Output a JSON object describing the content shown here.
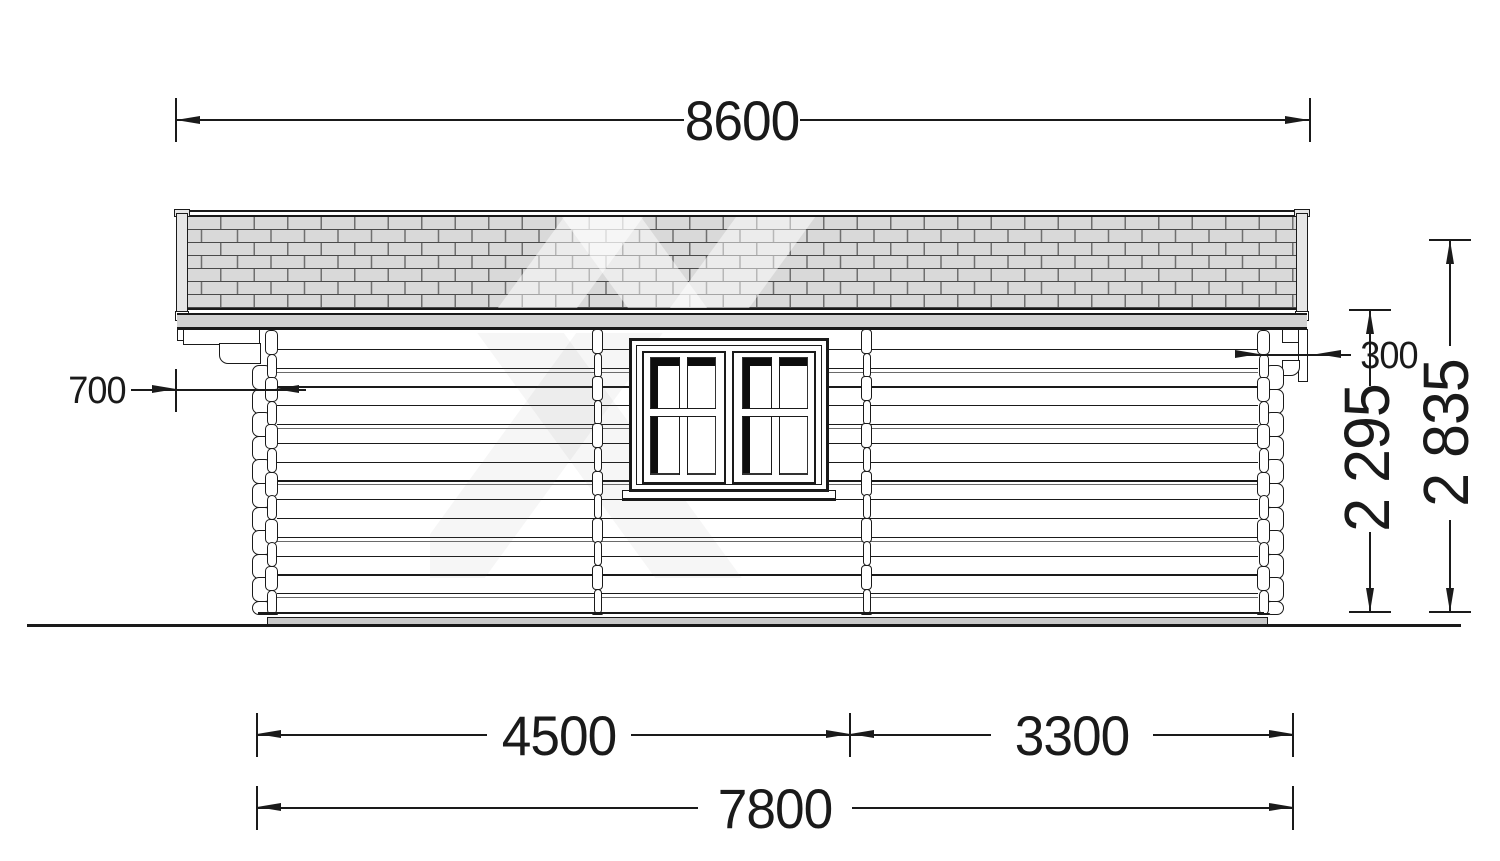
{
  "dimensions": {
    "total_width": "8600",
    "left_roof_overhang": "700",
    "right_roof_overhang": "300",
    "wall_height": "2 295",
    "total_height": "2 835",
    "section_left_width": "4500",
    "section_right_width": "3300",
    "total_length": "7800"
  },
  "colors": {
    "line": "#1a1a1a",
    "roof_shingle_fill": "#d9d9d9",
    "roof_joint_line": "#6f6f6f",
    "roof_course_line": "#4a4a4a",
    "fascia_fill": "#d2d2d2",
    "base_fill": "#c9c9c9",
    "window_shadow": "#0d0d0d",
    "watermark": "rgba(255,255,255,0.5)"
  }
}
